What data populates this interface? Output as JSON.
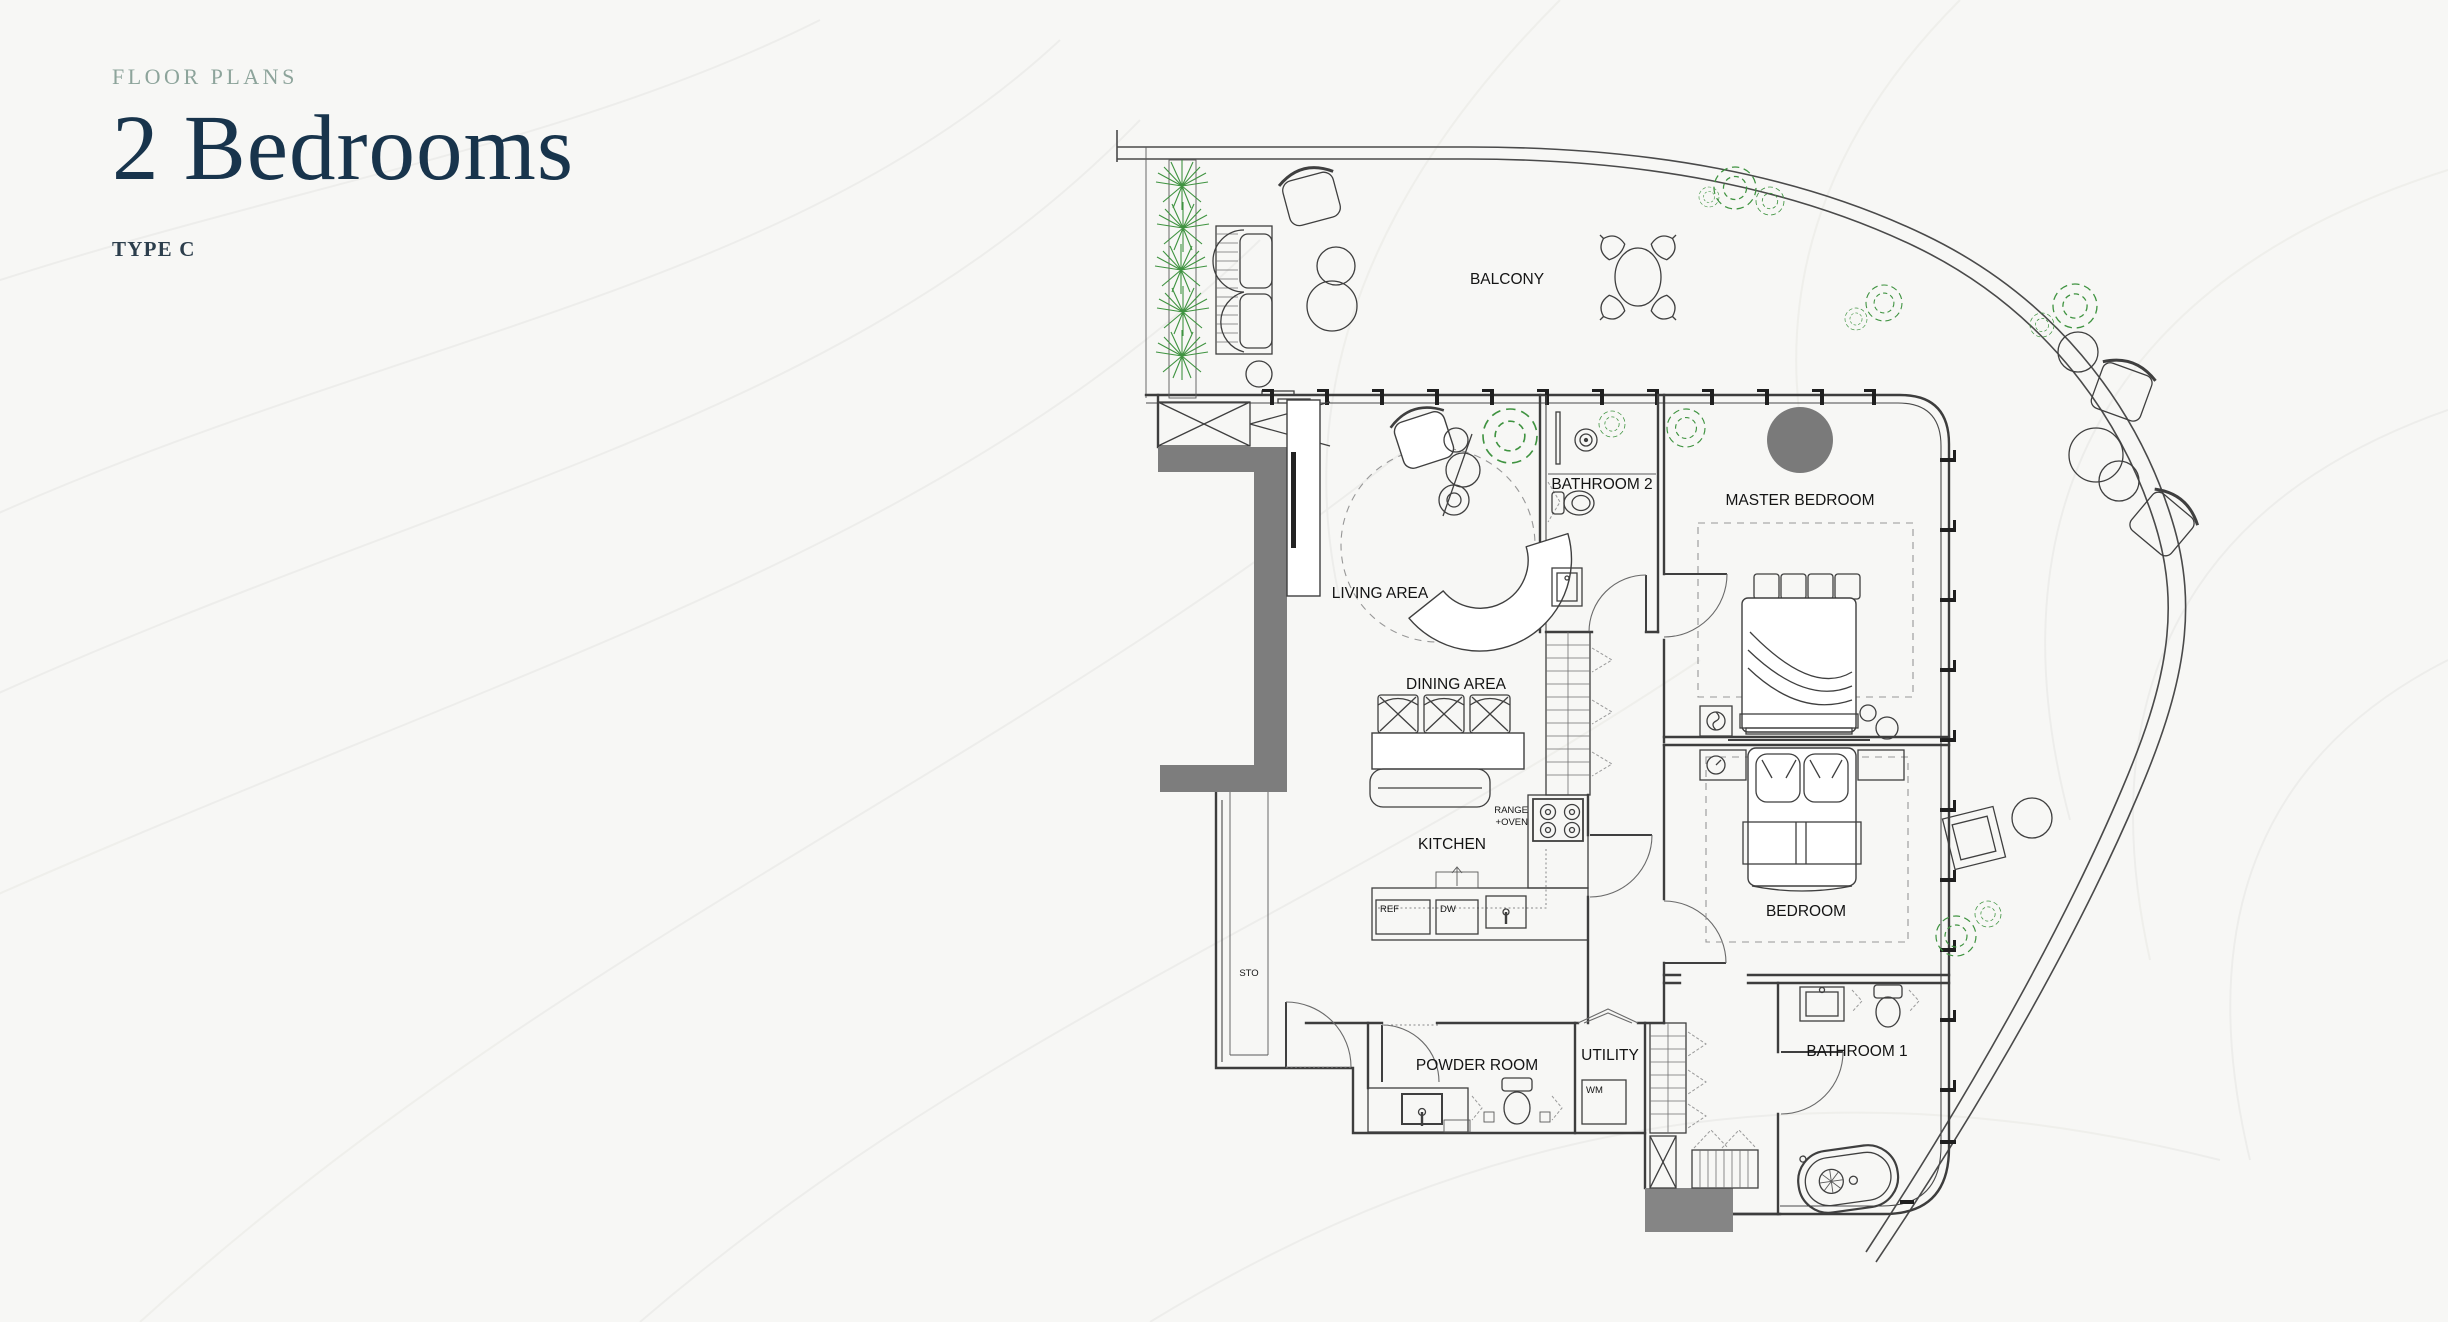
{
  "header": {
    "eyebrow": "FLOOR PLANS",
    "title": "2 Bedrooms",
    "subtitle": "TYPE C"
  },
  "colors": {
    "background": "#f7f7f5",
    "title_navy": "#18344c",
    "eyebrow_green": "#8da49b",
    "plan_line": "#3d3d3d",
    "wall_fill_gray": "#7d7d7d",
    "block_gray": "#858585",
    "tree_gray": "#7a7a7a",
    "plant_green": "#3f9340",
    "contour_gray": "#ededea"
  },
  "floorplan": {
    "labels": {
      "balcony": "BALCONY",
      "living": "LIVING AREA",
      "dining": "DINING AREA",
      "kitchen": "KITCHEN",
      "master": "MASTER BEDROOM",
      "bathroom2": "BATHROOM 2",
      "bedroom": "BEDROOM",
      "bathroom1": "BATHROOM 1",
      "powder": "POWDER ROOM",
      "utility": "UTILITY",
      "sto": "STO",
      "range_line1": "RANGE",
      "range_line2": "+OVEN",
      "ref": "REF",
      "dw": "DW",
      "wm": "WM"
    }
  }
}
